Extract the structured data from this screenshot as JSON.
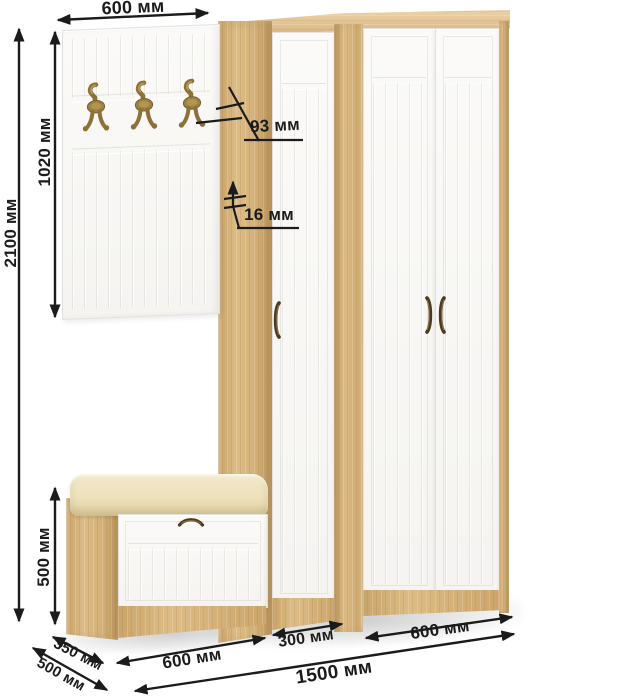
{
  "dimensions": {
    "panel_width": "600 мм",
    "panel_height": "1020 мм",
    "total_height": "2100 мм",
    "hook_projection": "93 мм",
    "panel_thickness": "16 мм",
    "bench_height": "500 мм",
    "bench_depth": "350 мм",
    "total_depth": "500 мм",
    "bench_width": "600 мм",
    "single_wardrobe_width": "300 мм",
    "double_wardrobe_width": "600 мм",
    "total_width": "1500 мм"
  },
  "furniture": {
    "coat_panel": {
      "hooks_count": 3
    },
    "single_door_wardrobe": {
      "doors_count": 1,
      "handles_count": 1
    },
    "double_door_wardrobe": {
      "doors_count": 2,
      "handles_count": 2
    },
    "shoe_bench": {
      "flaps_count": 1,
      "handles_count": 1
    }
  },
  "colors": {
    "oak": "#d9b478",
    "oak_light": "#e5c38c",
    "oak_dark": "#c29a5e",
    "door_white": "#f5f4f1",
    "groove": "#e3e2de",
    "cushion": "#eee1bc",
    "brass": "#8e7038",
    "bronze": "#4a3a20",
    "dimension_ink": "#1b1b1b"
  }
}
